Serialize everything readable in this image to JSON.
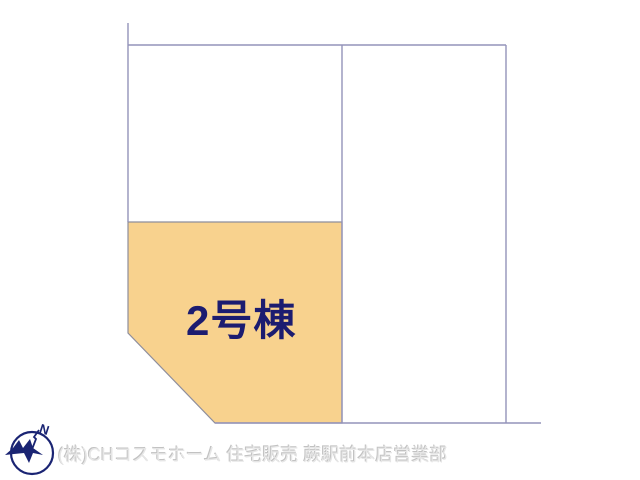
{
  "plot_plan": {
    "highlighted_lot_label": "2号棟"
  },
  "compass": {
    "north_label": "N"
  },
  "footer": {
    "company_text": "(株)CHコスモホーム 住宅販売 蕨駅前本店営業部"
  },
  "colors": {
    "background": "#FFFFFF",
    "boundary_line": "#9393BA",
    "lot_fill": "#F8D28E",
    "lot_stroke": "#8E8E9C",
    "lot_label": "#1C1C70",
    "watermark": "#E6E6E6",
    "watermark_shadow": "#C2C2C2",
    "compass": "#1A2473"
  }
}
